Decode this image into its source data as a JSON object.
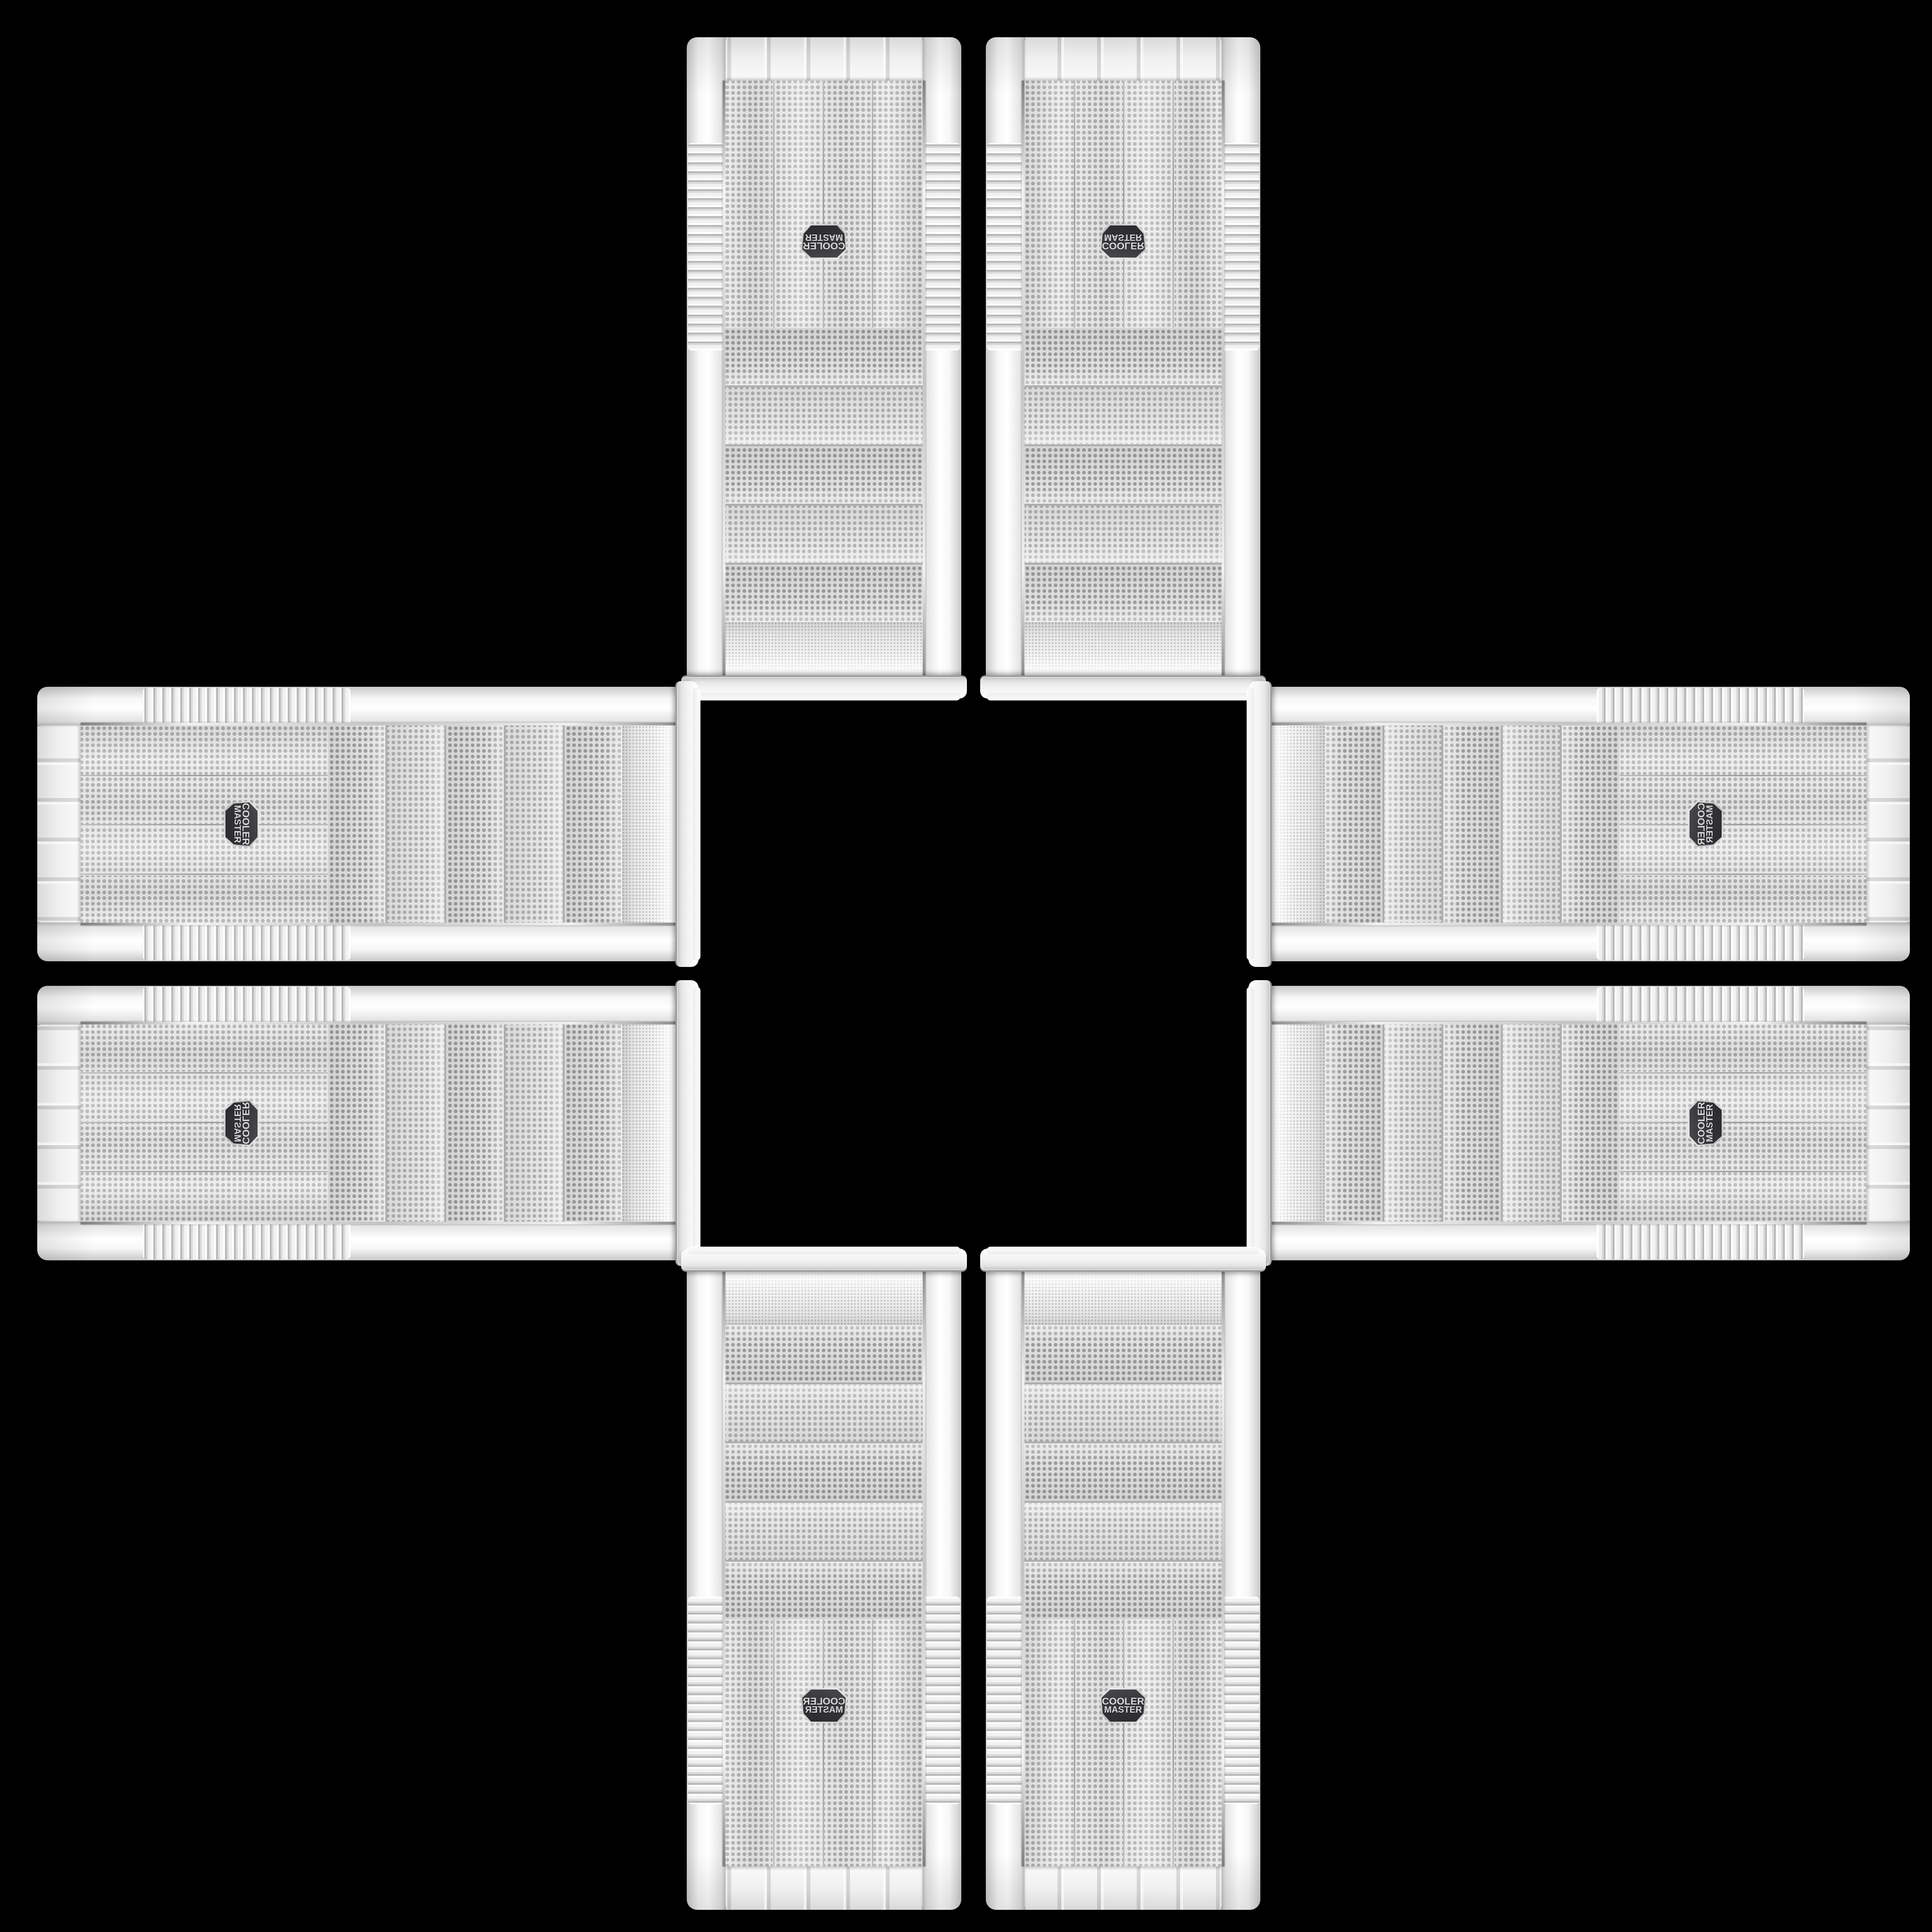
{
  "brand": "Cooler Master",
  "badge": {
    "line1": "COOLER",
    "line2": "MASTER"
  },
  "collage": {
    "description": "Eight identical white Cooler Master mesh-front PC tower cases arranged in a plus/cross pattern on a black background; drive-bay ends face the center, badge and footed bumper ends face outward; pairs are mirror images of each other.",
    "background_color": "#000000",
    "case_body_color": "#f2f2f2",
    "mesh_base_color": "#e9e9e9",
    "mesh_dot_color": "#ababab",
    "drive_bay_dot_color": "#9c9c9c",
    "fine_mesh_dot_color": "#cccccc",
    "chrome_trim_color": "#c4c4c4",
    "badge_background_color": "#333338",
    "badge_rim_color": "#c9c9c9",
    "badge_text_color": "#d9d9d9",
    "items": [
      {
        "position": "top-left",
        "orientation": "rotated-180"
      },
      {
        "position": "top-right",
        "orientation": "flipped-vertical"
      },
      {
        "position": "left-upper",
        "orientation": "rotated-90-cw"
      },
      {
        "position": "left-lower",
        "orientation": "rotated-90-cw-flipped"
      },
      {
        "position": "right-upper",
        "orientation": "rotated-90-ccw-flipped"
      },
      {
        "position": "right-lower",
        "orientation": "rotated-90-ccw"
      },
      {
        "position": "bottom-left",
        "orientation": "flipped-horizontal"
      },
      {
        "position": "bottom-right",
        "orientation": "upright"
      }
    ]
  }
}
